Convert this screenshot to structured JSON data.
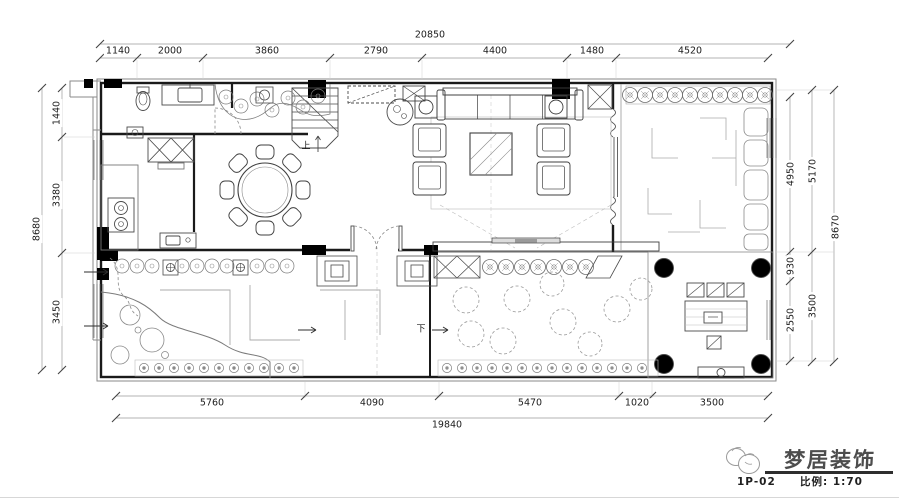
{
  "dimensions": {
    "top": {
      "total": "20850",
      "segments": [
        "1140",
        "2000",
        "3860",
        "2790",
        "4400",
        "1480",
        "4520"
      ]
    },
    "left": {
      "total": "8680",
      "segments": [
        "1440",
        "3380",
        "3450"
      ]
    },
    "right": {
      "total": "8670",
      "inner": [
        "4950",
        "930",
        "2550"
      ],
      "outer": [
        "5170",
        "3500"
      ]
    },
    "bottom": {
      "total": "19840",
      "segments": [
        "5760",
        "4090",
        "5470",
        "1020",
        "3500"
      ]
    }
  },
  "plan_labels": {
    "stair_up": "上",
    "entry_down": "下"
  },
  "title_block": {
    "sheet_no": "1P-02",
    "scale": "比例: 1:70",
    "brand": "梦居装饰"
  },
  "colors": {
    "wall": "#1a1a1a",
    "dim_line": "#9a9a9a",
    "dim_text": "#1c1c1c",
    "column_fill": "#000000",
    "paper": "#ffffff"
  }
}
